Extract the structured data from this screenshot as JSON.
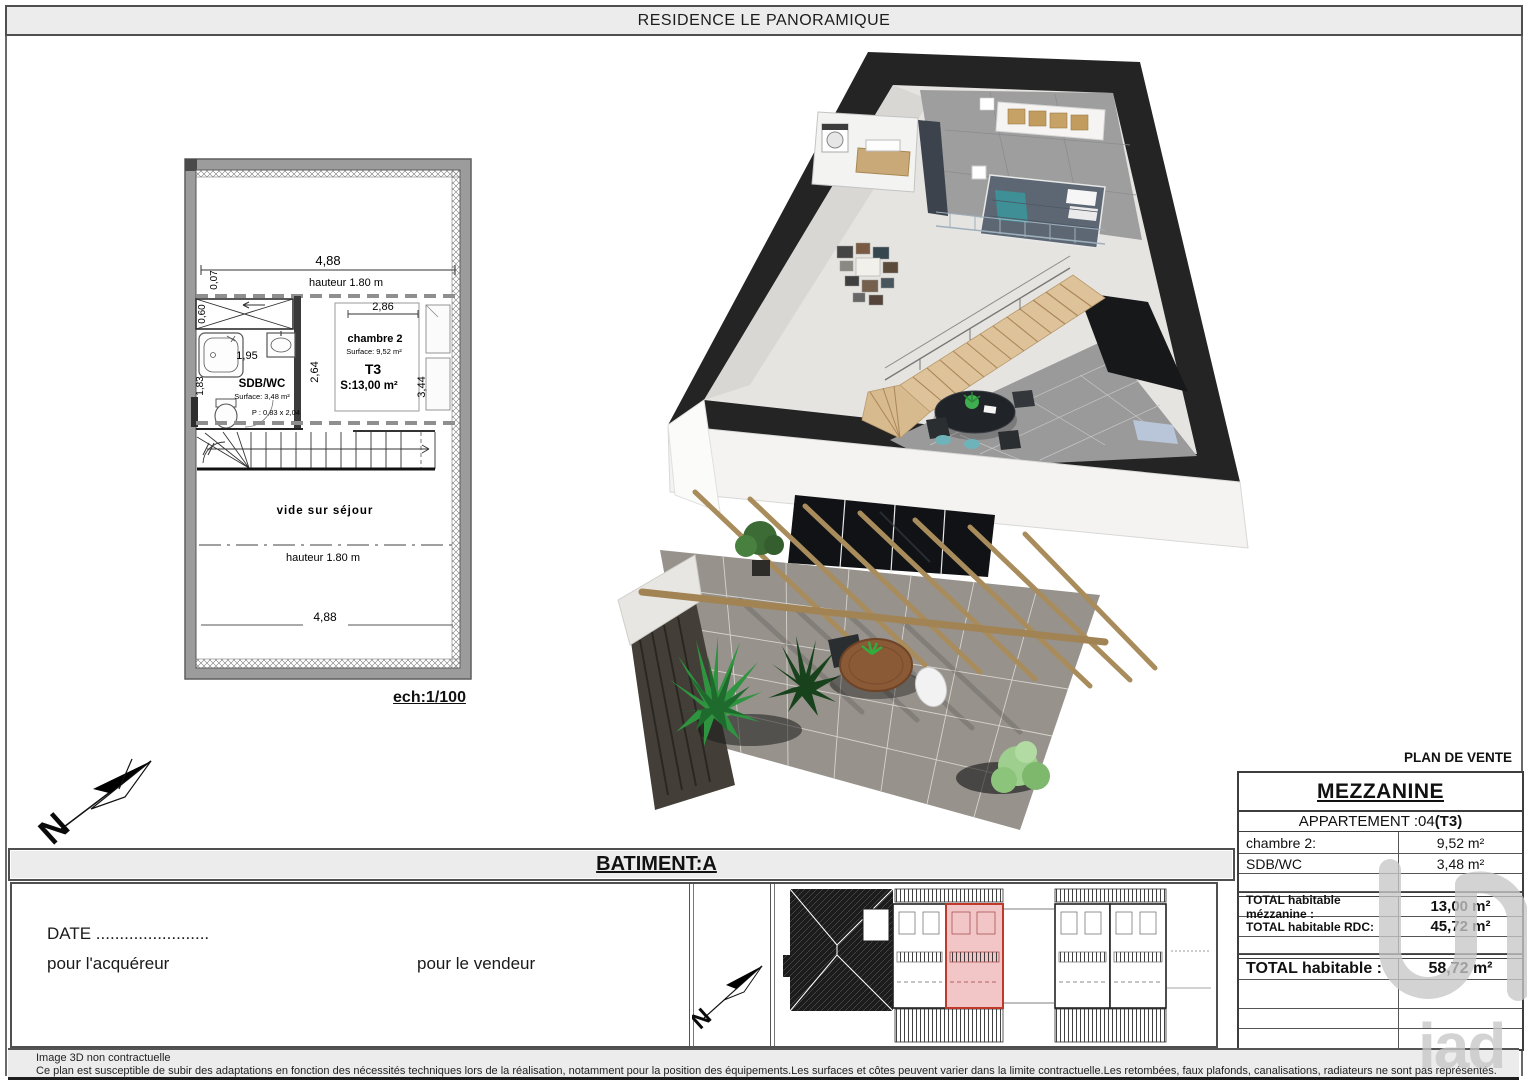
{
  "page": {
    "title": "RESIDENCE LE PANORAMIQUE",
    "scale_label": "ech:1/100",
    "footer_line1": "Image 3D non contractuelle",
    "footer_line2": "Ce plan est susceptible de subir des adaptations en fonction des nécessités techniques lors de la réalisation, notamment pour la position des équipements.Les surfaces et côtes peuvent varier dans la limite contractuelle.Les retombées, faux plafonds, canalisations, radiateurs ne sont pas représentés.",
    "watermark": "iad"
  },
  "compass": {
    "north": "N"
  },
  "batiment": {
    "label": "BATIMENT:A"
  },
  "signature": {
    "date_label": "DATE ........................",
    "buyer_label": "pour l'acquéreur",
    "seller_label": "pour le vendeur"
  },
  "floor_plan": {
    "dim_width_top": "4,88",
    "note_height_top": "hauteur 1.80 m",
    "dim_007a": "0,07",
    "dim_060": "0,60",
    "dim_007b": "0,07",
    "dim_286": "2,86",
    "dim_264": "2,64",
    "dim_344": "3,44",
    "dim_195": "1,95",
    "dim_183": "1,83",
    "room1_name": "chambre 2",
    "room1_surface": "Surface: 9,52 m²",
    "unit_type": "T3",
    "unit_surface": "S:13,00 m²",
    "room2_name": "SDB/WC",
    "room2_surface": "Surface: 3,48 m²",
    "door_size": "P : 0,83 x 2,04",
    "void_label": "vide sur séjour",
    "note_height_bottom": "hauteur 1.80 m",
    "dim_width_bottom": "4,88"
  },
  "sale_table": {
    "header": "PLAN DE VENTE",
    "level": "MEZZANINE",
    "apartment_prefix": "APPARTEMENT :04 ",
    "apartment_type": "(T3)",
    "rows": [
      {
        "label": "chambre 2:",
        "value": "9,52 m²"
      },
      {
        "label": "SDB/WC",
        "value": "3,48 m²"
      }
    ],
    "totals": [
      {
        "label": "TOTAL habitable mézzanine :",
        "value": "13,00 m²"
      },
      {
        "label": "TOTAL habitable RDC:",
        "value": "45,72 m²"
      }
    ],
    "grand_total": {
      "label": "TOTAL habitable :",
      "value": "58,72 m²"
    }
  }
}
